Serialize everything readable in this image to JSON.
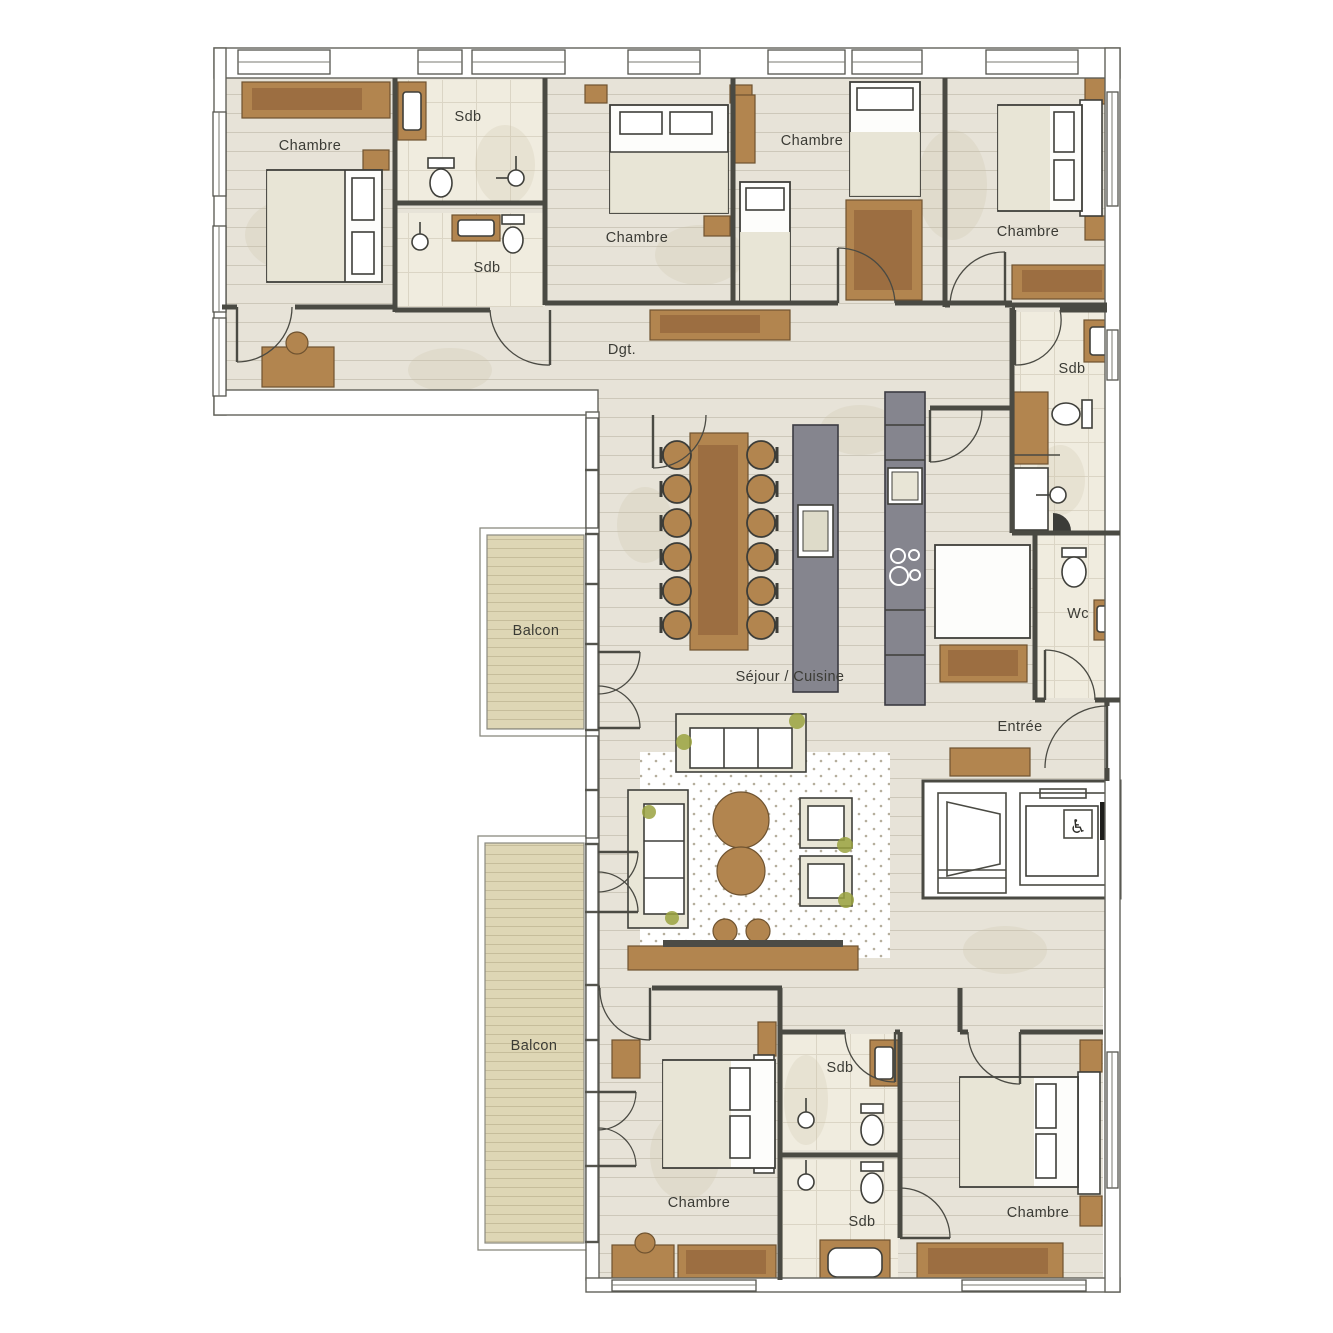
{
  "document": {
    "type": "apartment-floor-plan",
    "language": "fr"
  },
  "rooms": [
    {
      "id": "chambre-nw",
      "label": "Chambre",
      "x": 310,
      "y": 150
    },
    {
      "id": "sdb-nw-1",
      "label": "Sdb",
      "x": 468,
      "y": 121
    },
    {
      "id": "sdb-nw-2",
      "label": "Sdb",
      "x": 487,
      "y": 272
    },
    {
      "id": "chambre-n1",
      "label": "Chambre",
      "x": 637,
      "y": 242
    },
    {
      "id": "chambre-n2",
      "label": "Chambre",
      "x": 812,
      "y": 145
    },
    {
      "id": "chambre-ne",
      "label": "Chambre",
      "x": 1028,
      "y": 236
    },
    {
      "id": "sdb-ne",
      "label": "Sdb",
      "x": 1072,
      "y": 373
    },
    {
      "id": "degagement",
      "label": "Dgt.",
      "x": 622,
      "y": 354
    },
    {
      "id": "sejour-cuisine",
      "label": "Séjour / Cuisine",
      "x": 790,
      "y": 681
    },
    {
      "id": "entree",
      "label": "Entrée",
      "x": 1020,
      "y": 731
    },
    {
      "id": "wc",
      "label": "Wc",
      "x": 1078,
      "y": 618
    },
    {
      "id": "balcon-nord",
      "label": "Balcon",
      "x": 536,
      "y": 635
    },
    {
      "id": "balcon-sud",
      "label": "Balcon",
      "x": 534,
      "y": 1050
    },
    {
      "id": "chambre-sw",
      "label": "Chambre",
      "x": 699,
      "y": 1207
    },
    {
      "id": "sdb-s1",
      "label": "Sdb",
      "x": 840,
      "y": 1072
    },
    {
      "id": "sdb-s2",
      "label": "Sdb",
      "x": 862,
      "y": 1226
    },
    {
      "id": "chambre-se",
      "label": "Chambre",
      "x": 1038,
      "y": 1217
    }
  ],
  "features": {
    "elevator_accessible_icon": "♿",
    "dining_seats": 12,
    "bedrooms_count": 6,
    "bathrooms_count": 5,
    "balconies_count": 2
  },
  "colors": {
    "wood_floor": "#e7e3d8",
    "plank_line": "#cdc8ba",
    "tile_floor": "#f0ecdf",
    "tile_line": "#dbd5c5",
    "balcony_deck": "#ded6b5",
    "deck_line": "#c6bd9b",
    "wall": "#4a4a43",
    "furniture_brown": "#b2854f",
    "furniture_brown_dark": "#9c6e41",
    "kitchen_gray": "#85858e",
    "sofa_cream": "#e9e6d7",
    "label_text": "#3b3b35",
    "plant_olive": "#9aa23f"
  }
}
